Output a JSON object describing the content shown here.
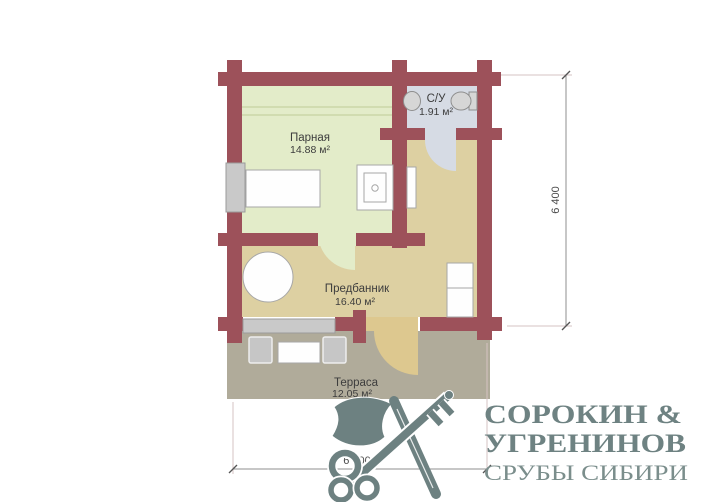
{
  "plan": {
    "rooms": {
      "parnaya": {
        "label": "Парная",
        "area": "14.88 м²"
      },
      "su": {
        "label": "С/У",
        "area": "1.91 м²"
      },
      "predbannik": {
        "label": "Предбанник",
        "area": "16.40 м²"
      },
      "terrasa": {
        "label": "Терраса",
        "area": "12.05 м²"
      }
    },
    "dimensions": {
      "height": "6 400",
      "width": "6 400"
    }
  },
  "logo": {
    "line1": "СОРОКИН &",
    "line2": "УГРЕНИНОВ",
    "line3": "СРУБЫ СИБИРИ"
  },
  "colors": {
    "wall": "#9d515a",
    "parnaya_floor": "#e3ecc9",
    "su_floor": "#d6dbe4",
    "predbannik_floor": "#ddd0a2",
    "terrace_floor": "#b0ab9a",
    "terrace_door": "#ddc88f",
    "logo": "#6d8181"
  }
}
